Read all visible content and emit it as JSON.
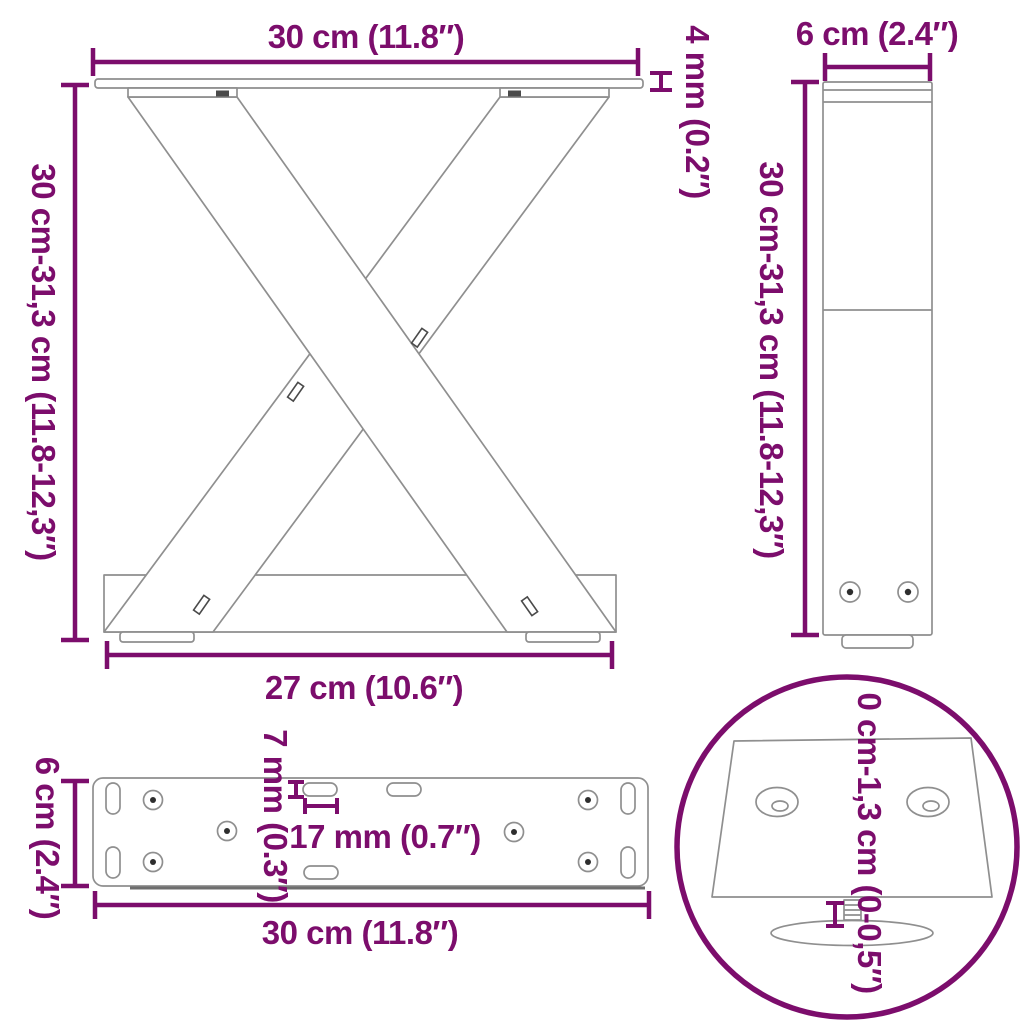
{
  "title": "Table legs dimension diagram",
  "colors": {
    "accent": "#7C0D6C",
    "drawing_line": "#8F8F8F",
    "background": "#FFFFFF"
  },
  "front_view": {
    "width_top": "30 cm (11.8″)",
    "height": "30 cm-31,3 cm (11.8-12,3″)",
    "plate_thickness": "4 mm (0.2″)",
    "width_bottom": "27 cm (10.6″)"
  },
  "side_view": {
    "depth": "6 cm (2.4″)",
    "height": "30 cm-31,3 cm (11.8-12,3″)"
  },
  "plate_view": {
    "depth": "6 cm (2.4″)",
    "width": "30 cm (11.8″)",
    "slot_width": "7 mm (0.3″)",
    "slot_length": "17 mm (0.7″)"
  },
  "detail_view": {
    "adjustable_range": "0 cm-1,3 cm (0-0,5″)"
  }
}
